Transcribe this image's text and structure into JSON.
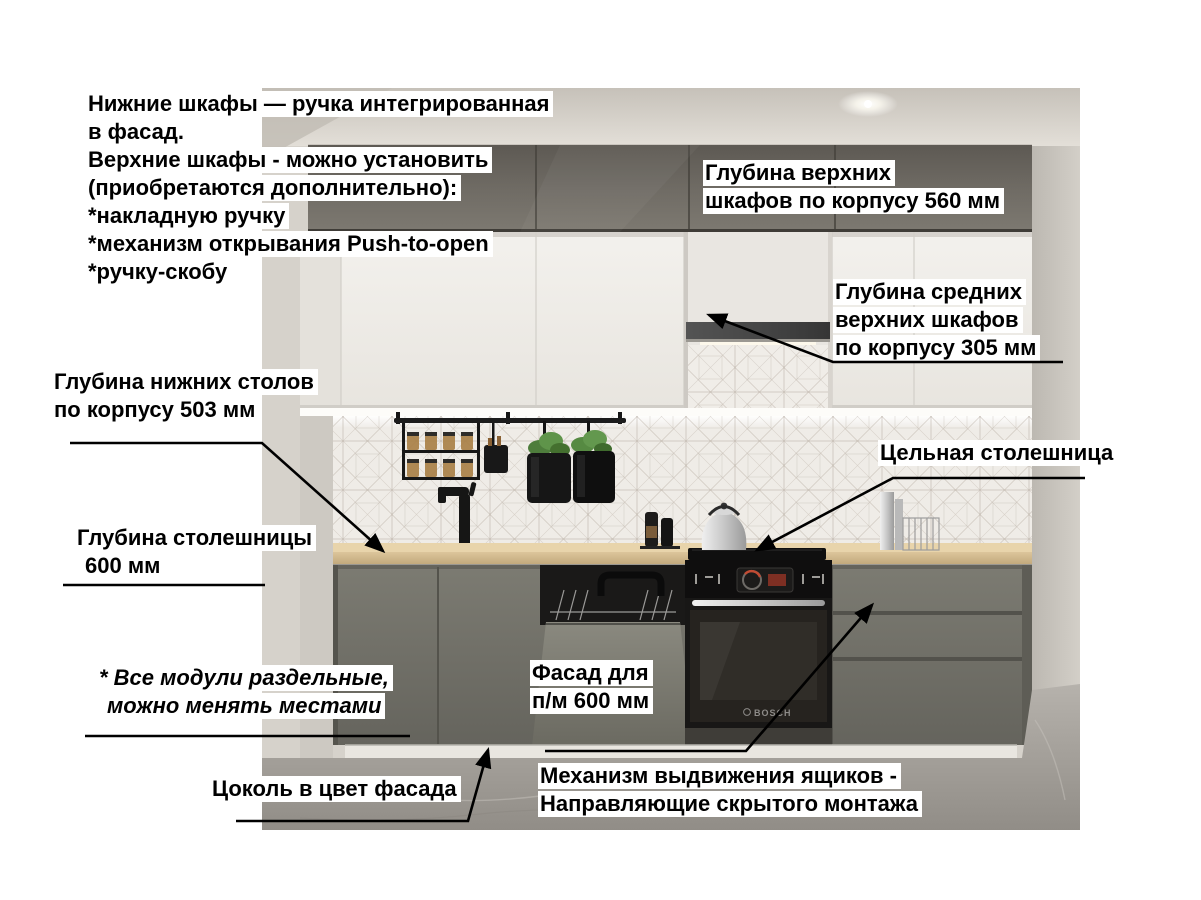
{
  "page": {
    "width": 1201,
    "height": 900,
    "background": "#ffffff"
  },
  "palette": {
    "annotation_text": "#000000",
    "annotation_highlight": "#ffffff",
    "arrow": "#000000",
    "upper_cabinet_grey": "#6b665f",
    "wall_cabinet_white": "#edebe6",
    "base_cabinet_facade": "#73726a",
    "countertop_wood": "#ddc79d",
    "appliance_black": "#1d1b1a",
    "backsplash_tile": "#efece7",
    "floor_concrete": "#a9a59f",
    "ceiling": "#d5d0c9"
  },
  "annotations": {
    "handles_note": {
      "lines": [
        "Нижние шкафы — ручка интегрированная",
        "в фасад.",
        "Верхние шкафы - можно установить",
        "(приобретаются дополнительно):",
        "*накладную ручку",
        "*механизм открывания Push-to-open",
        "*ручку-скобу"
      ]
    },
    "upper_depth": {
      "lines": [
        "Глубина верхних",
        "шкафов по корпусу 560 мм"
      ]
    },
    "mid_upper_depth": {
      "lines": [
        "Глубина средних",
        "верхних шкафов",
        "по корпусу 305 мм"
      ]
    },
    "base_depth": {
      "lines": [
        "Глубина нижних столов",
        "по корпусу 503 мм"
      ]
    },
    "countertop_solid": {
      "lines": [
        "Цельная столешница"
      ]
    },
    "countertop_depth": {
      "lines": [
        "Глубина столешницы",
        "600 мм"
      ]
    },
    "modules_note": {
      "lines": [
        "* Все модули раздельные,",
        "можно менять местами"
      ]
    },
    "dishwasher_facade": {
      "lines": [
        "Фасад для",
        "п/м 600 мм"
      ]
    },
    "plinth_note": {
      "lines": [
        "Цоколь в цвет фасада"
      ]
    },
    "drawer_mechanism": {
      "lines": [
        "Механизм выдвижения ящиков -",
        "Направляющие скрытого монтажа"
      ]
    }
  },
  "scene": {
    "oven_brand": "BOSCH"
  }
}
